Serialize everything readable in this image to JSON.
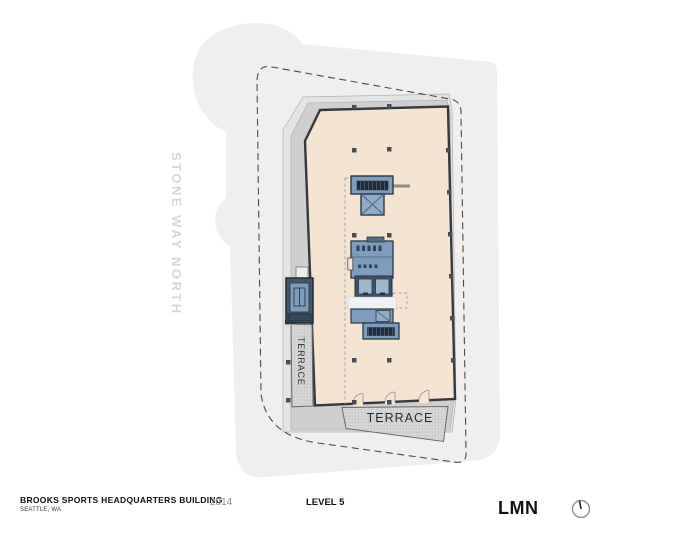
{
  "plan": {
    "street_label": "STONE WAY NORTH",
    "terraces": {
      "west_label": "TERRACE",
      "south_label": "TERRACE"
    },
    "colors": {
      "site": "#f0efee",
      "roof_band_light": "#e4e4e4",
      "roof_band_dark": "#cfcfcf",
      "floor_plate": "#f6e4d2",
      "wall": "#35393f",
      "core_blue": "#7d9cbe",
      "core_dark": "#44576b",
      "elevator_cab": "#9db6cf",
      "stair_tread": "#202c39",
      "terrace_hatch": "#d8d8d8",
      "property_line": "#4a4a4a",
      "street_label_color": "#d7d7d7"
    }
  },
  "footer": {
    "project_title": "BROOKS SPORTS HEADQUARTERS BUILDING",
    "project_location": "SEATTLE, WA",
    "year": "2014",
    "sheet_title": "LEVEL 5",
    "firm_logo": "LMN",
    "north_icon": "north-arrow-icon"
  }
}
